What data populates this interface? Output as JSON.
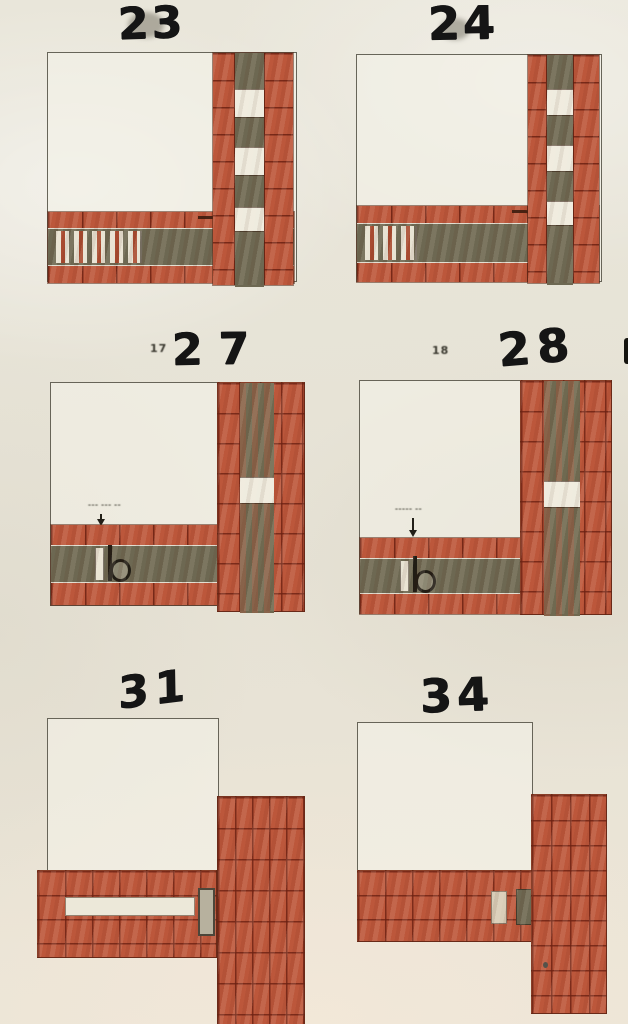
{
  "page": {
    "kind": "scanned book page with six brick-bond corner plan diagrams",
    "width_px": 628,
    "height_px": 1024
  },
  "palette": {
    "paper": "#e8e5d9",
    "brick": "#bc573b",
    "brick_joint": "#6c2112",
    "infill_olive": "#6d6852",
    "block_white": "#efecdf",
    "room_outline": "#58554a",
    "marker_ink": "#151515"
  },
  "figures": [
    {
      "name": "figure-23",
      "handwritten_number": "23",
      "printed_number": "",
      "caption": ""
    },
    {
      "name": "figure-24",
      "handwritten_number": "24",
      "printed_number": "",
      "caption": ""
    },
    {
      "name": "figure-27",
      "handwritten_number": "27",
      "printed_number": "17",
      "caption": "––– ––– ––"
    },
    {
      "name": "figure-28",
      "handwritten_number": "28",
      "printed_number": "18",
      "caption": "––––– ––"
    },
    {
      "name": "figure-31",
      "handwritten_number": "31",
      "printed_number": "",
      "caption": ""
    },
    {
      "name": "figure-34",
      "handwritten_number": "34",
      "printed_number": "",
      "caption": ""
    }
  ]
}
